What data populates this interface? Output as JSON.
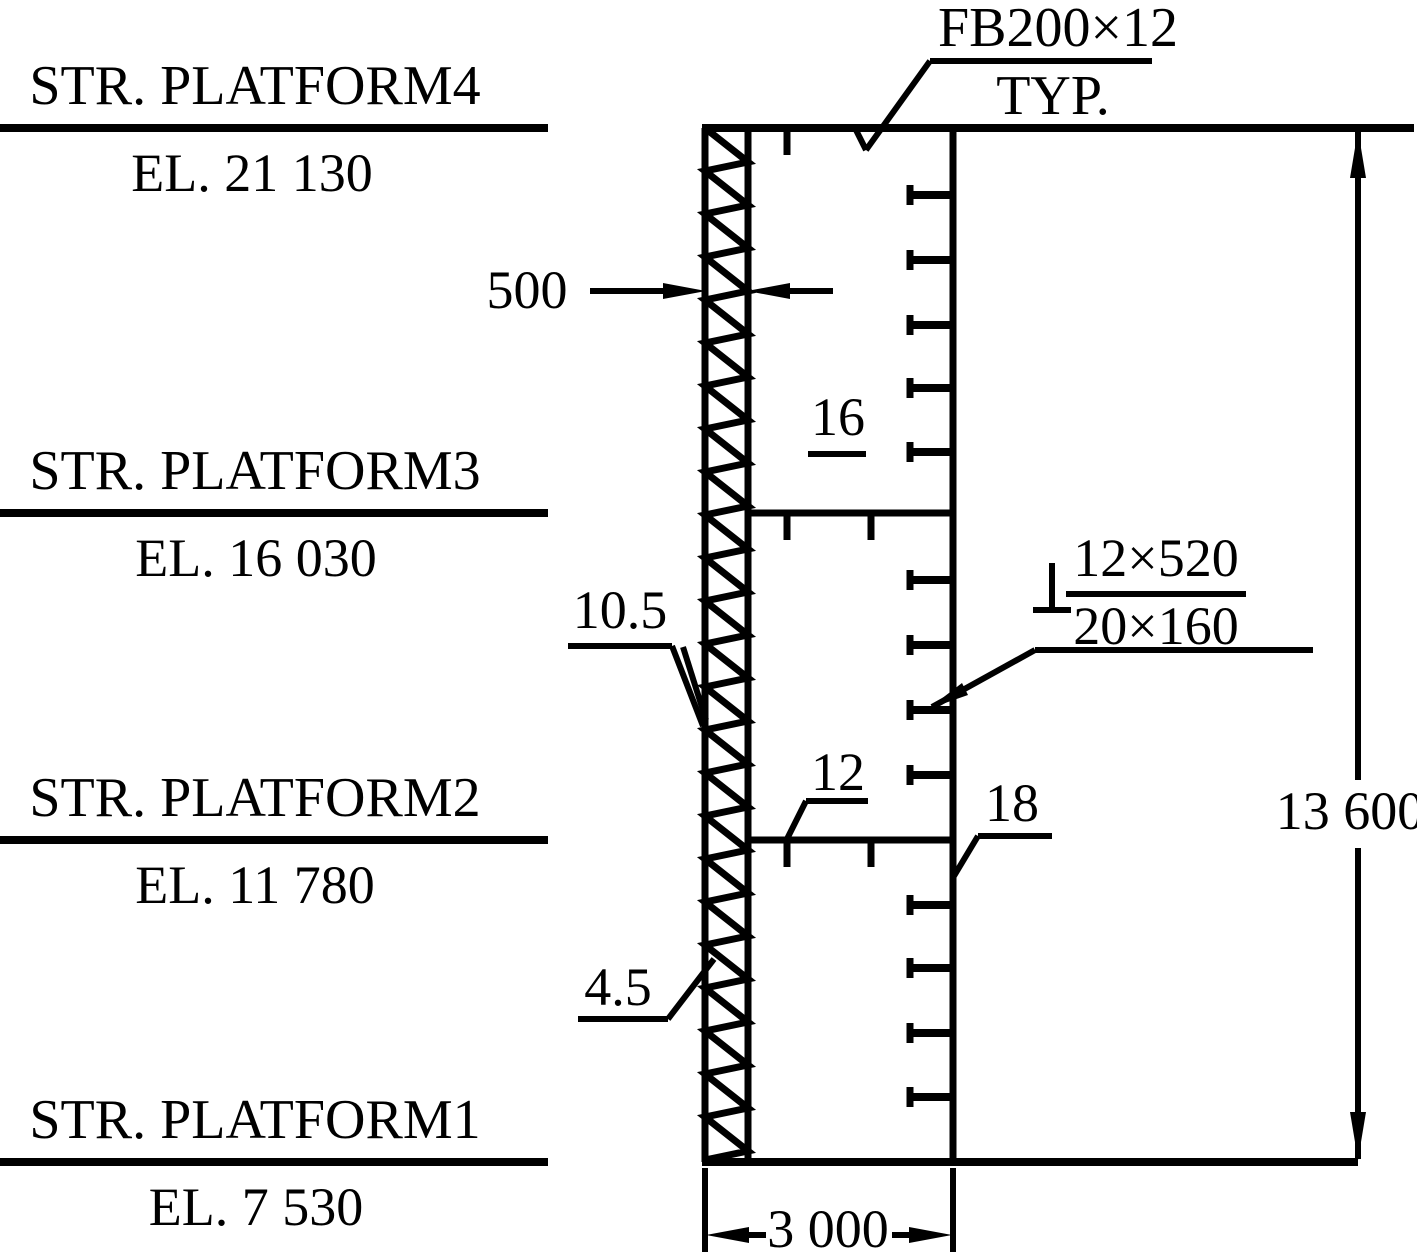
{
  "drawing": {
    "platforms": [
      {
        "name": "STR. PLATFORM4",
        "elevation": "EL. 21 130"
      },
      {
        "name": "STR. PLATFORM3",
        "elevation": "EL. 16 030"
      },
      {
        "name": "STR. PLATFORM2",
        "elevation": "EL. 11 780"
      },
      {
        "name": "STR. PLATFORM1",
        "elevation": "EL. 7 530"
      }
    ],
    "callouts": {
      "flat_bar": "FB200×12",
      "typical": "TYP.",
      "gap_width": "500",
      "web_plate_thickness": "16",
      "weld_size_upper": "10.5",
      "weld_spec_numerator": "12×520",
      "weld_spec_denominator": "20×160",
      "splice_plate_thickness": "12",
      "flange_plate_thickness": "18",
      "weld_size_lower": "4.5"
    },
    "dimensions": {
      "total_height": "13 600",
      "column_width": "3 000"
    },
    "colors": {
      "line": "#000000",
      "background": "#ffffff"
    }
  }
}
